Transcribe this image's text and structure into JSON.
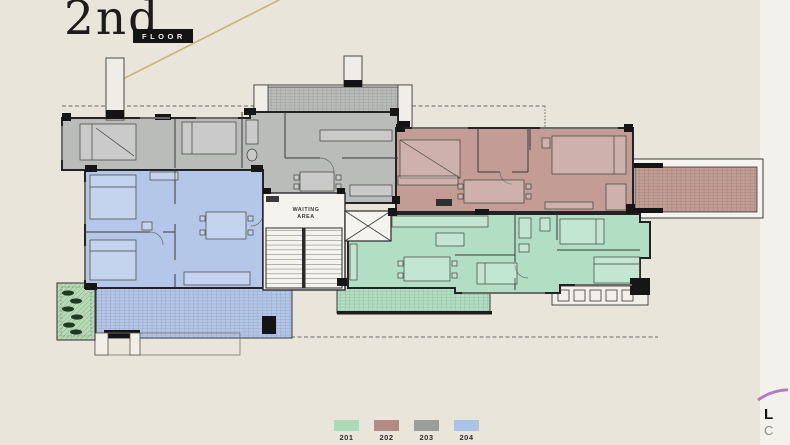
{
  "title": {
    "floor_number": "2nd",
    "floor_label": "FLOOR"
  },
  "plan": {
    "core_label_line1": "WAITING",
    "core_label_line2": "AREA",
    "units": [
      {
        "id": "201",
        "color": "#b2dfc3"
      },
      {
        "id": "202",
        "color": "#c29c95"
      },
      {
        "id": "203",
        "color": "#babcba"
      },
      {
        "id": "204",
        "color": "#b4c7e9"
      }
    ]
  },
  "legend": {
    "items": [
      {
        "label": "201",
        "color": "#abdbb8"
      },
      {
        "label": "202",
        "color": "#b28b84"
      },
      {
        "label": "203",
        "color": "#9c9e9c"
      },
      {
        "label": "204",
        "color": "#a9c4e6"
      }
    ]
  },
  "logo": {
    "letter1": "L",
    "letter2": "C"
  },
  "colors": {
    "background": "#e9e5db",
    "wall": "#2b2b2b",
    "accent_line": "#c9b57c",
    "planter": "#b7d9b5",
    "core_floor": "#f5f3ee"
  }
}
